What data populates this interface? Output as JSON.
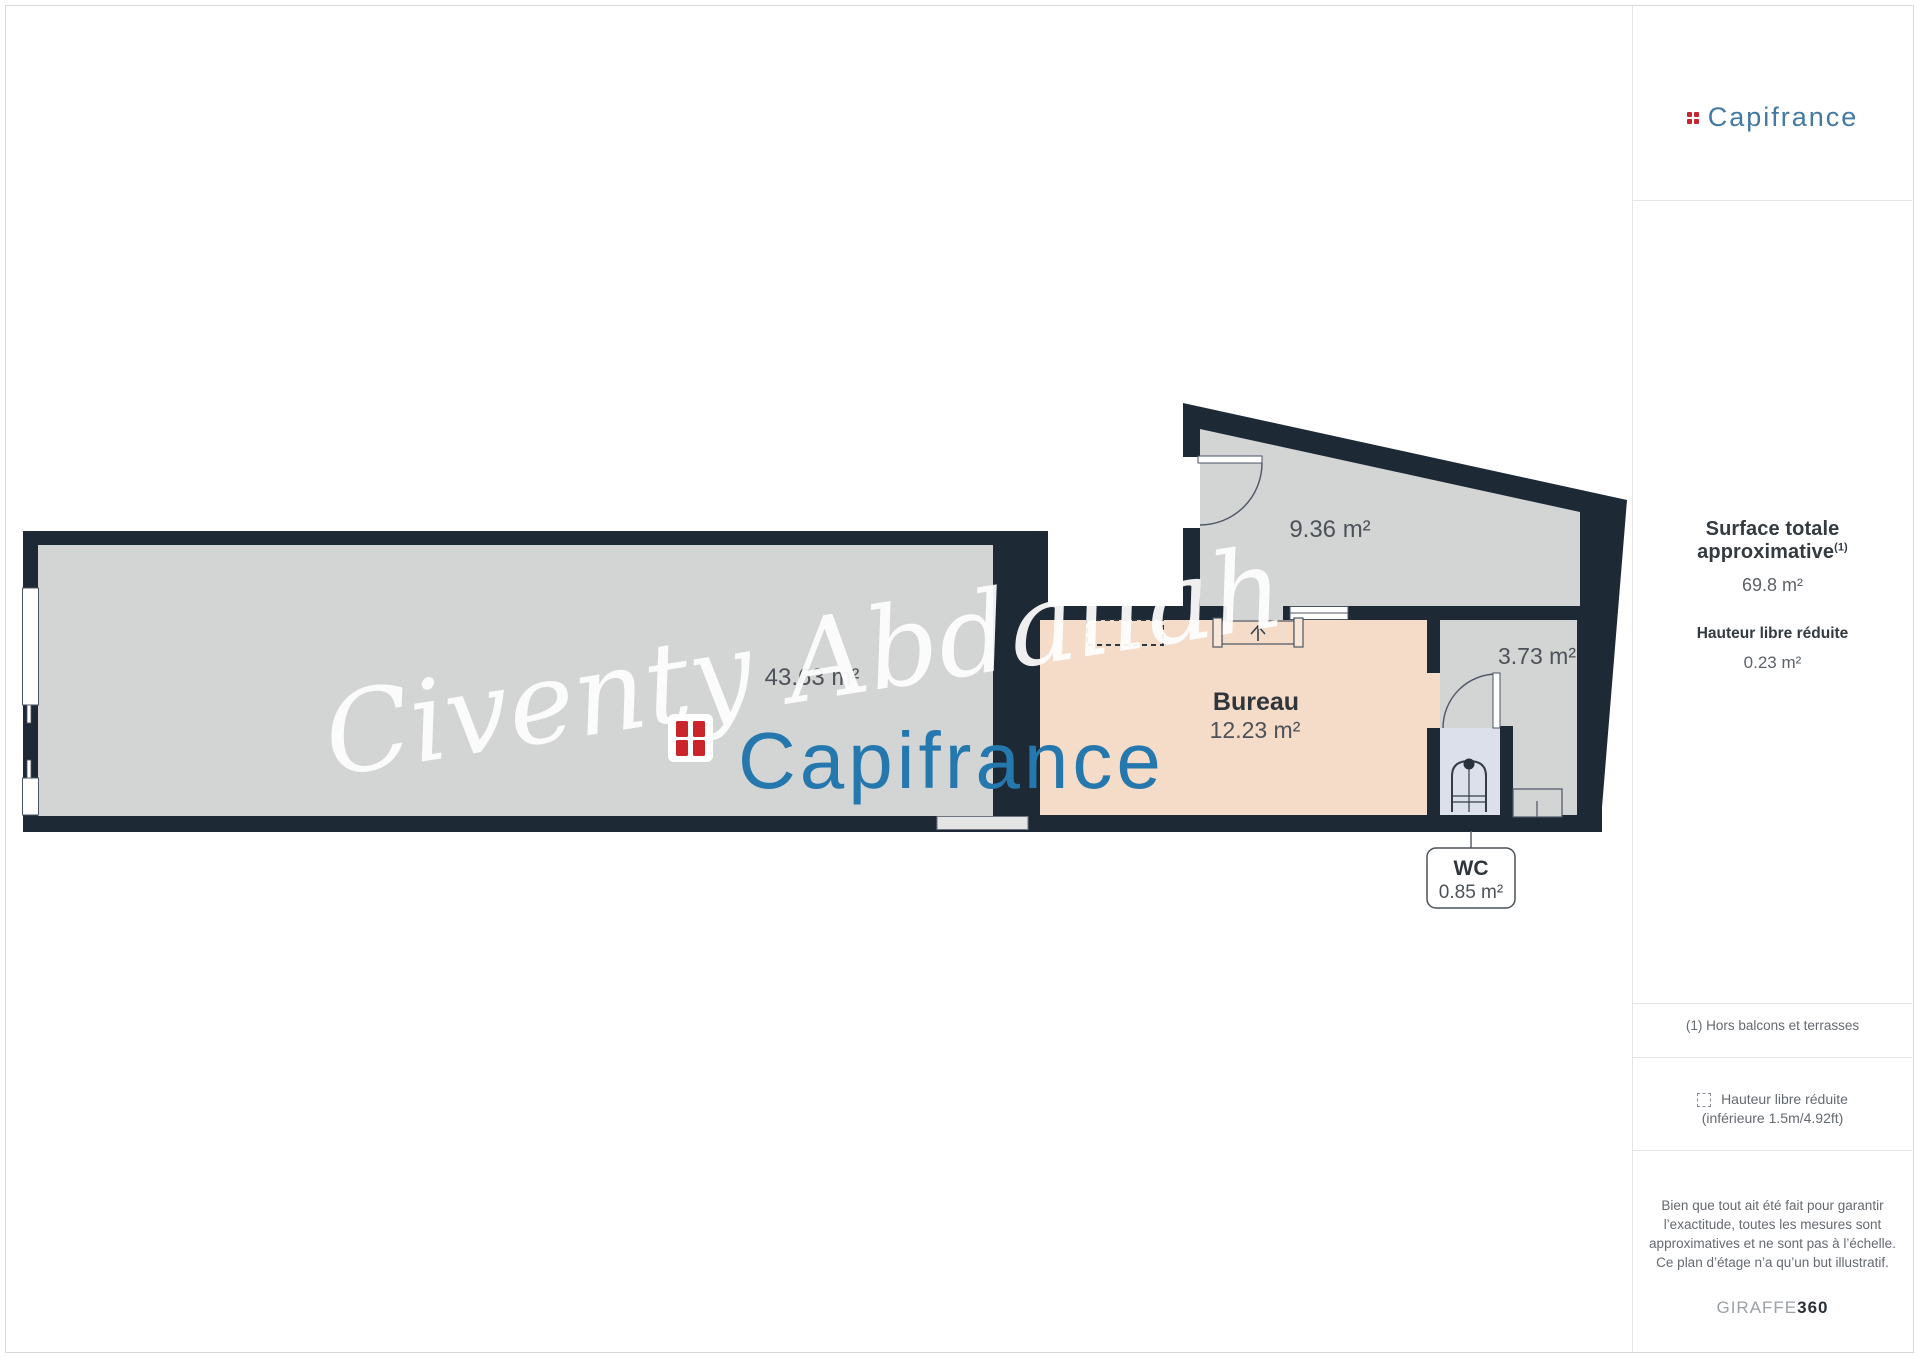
{
  "header_logo": {
    "brand": "Capifrance",
    "icon": "capifrance-grid-icon"
  },
  "watermark": {
    "script": "Civenty Abdallah",
    "brand": "Capifrance"
  },
  "plan": {
    "rooms": [
      {
        "id": "main-room",
        "area_label": "43.63 m²"
      },
      {
        "id": "room-936",
        "area_label": "9.36 m²"
      },
      {
        "id": "bureau",
        "name": "Bureau",
        "area_label": "12.23 m²"
      },
      {
        "id": "room-373",
        "area_label": "3.73 m²"
      },
      {
        "id": "wc",
        "name": "WC",
        "area_label": "0.85 m²"
      }
    ]
  },
  "sidebar": {
    "surface_title": "Surface totale approximative",
    "surface_sup": "(1)",
    "surface_value": "69.8 m²",
    "height_title": "Hauteur libre réduite",
    "height_value": "0.23 m²",
    "footnote": "(1) Hors balcons et terrasses",
    "legend_line1": "Hauteur libre réduite",
    "legend_line2": "(inférieure 1.5m/4.92ft)",
    "disclaimer": "Bien que tout ait été fait pour garantir l’exactitude, toutes les mesures sont approximatives et ne sont pas à l’échelle. Ce plan d’étage n’a qu’un but illustratif.",
    "brand_giraffe": "GIRAFFE",
    "brand_360": "360"
  },
  "colors": {
    "wall": "#1e2936",
    "floor_gray": "#d3d4d4",
    "floor_bureau": "#f4dcc9",
    "floor_wc": "#dce0ea",
    "brand_blue": "#2478ad",
    "brand_blue_small": "#4379a2",
    "brand_red": "#c52630",
    "divider": "#e4e5e7"
  }
}
